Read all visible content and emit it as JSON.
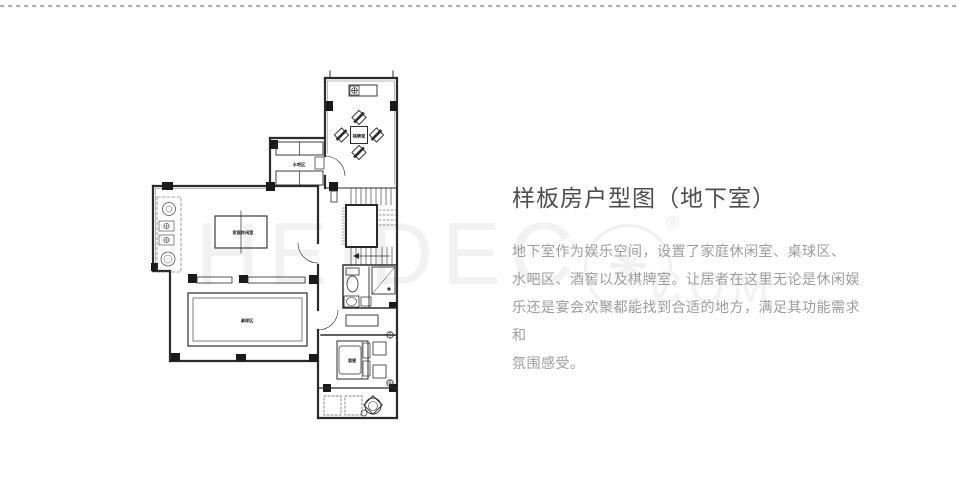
{
  "article": {
    "title": "样板房户型图（地下室）",
    "lines": [
      "地下室作为娱乐空间，设置了家庭休闲室、桌球区、",
      "水吧区、酒窖以及棋牌室。让居者在这里无论是休闲娱",
      "乐还是宴会欢聚都能找到合适的地方，满足其功能需求和",
      "氛围感受。"
    ],
    "title_color": "#4e4e4e",
    "body_color": "#9d9d9d"
  },
  "watermark": {
    "letters": "HEIDEC",
    "logo_glyph": "❋",
    "registered": "®",
    "suffix": ".COM",
    "color": "#f2f2f2"
  },
  "floorplan": {
    "wall_color": "#2b2b2b",
    "rooms": [
      {
        "name": "棋牌室"
      },
      {
        "name": "水吧区"
      },
      {
        "name": "家庭休闲室"
      },
      {
        "name": "桌球区"
      },
      {
        "name": "酒窖"
      }
    ]
  }
}
